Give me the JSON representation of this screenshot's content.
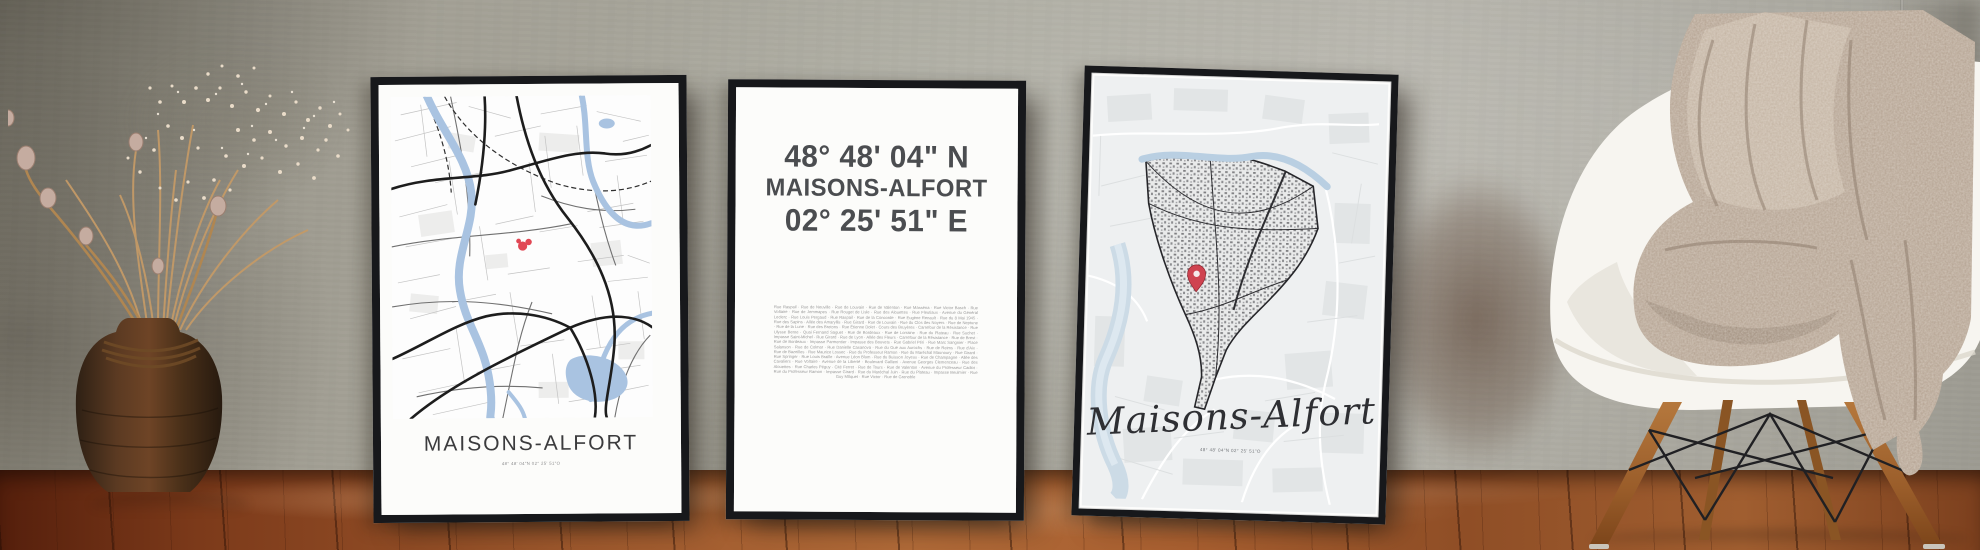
{
  "posters": {
    "left": {
      "title": "MAISONS-ALFORT",
      "coordinates": "48° 48' 04\"N  02° 25' 51\"O"
    },
    "middle": {
      "latitude": "48° 48' 04\" N",
      "city": "MAISONS-ALFORT",
      "longitude": "02° 25' 51\" E",
      "street_list": "Rue Raspail · Rue de Neuville · Rue de Louvain · Rue de Valenton · Rue Masséna · Rue Victor Basch · Rue Voltaire · Rue de Jemmapes · Rue Rouget de Lisle · Rue des Alouettes · Rue Fleutiaux · Avenue du Général Leclerc · Rue Louis Pergaud · Rue Raspail · Rue de la Concorde · Rue Eugène Renault · Rue du 8 Mai 1945 · Rue des Sapins · Allée des Amaryllis · Rue Girard · Rue de Louvain · Rue du Clos des Noyers · Rue de Neptune · Rue de la Lune · Rue des Bretons · Rue Étienne Dolet · Cours des Bruyères · Carrefour de la Résistance · Rue Ulysse Berne · Quai Fernand Saguet · Rue de Bordeaux · Rue de Lorraine · Rue du Plateau · Rue Suchet · Impasse Saint-Michel · Rue Girard · Rue de Lyon · Allée des Fleurs · Carrefour de la Résistance · Rue de Brest · Rue de Bordeaux · Impasse Parmentier · Impasse des Bouvets · Rue Gabriel Péri · Rue Marc Sangnier · Place Salanson · Rue de Colmar · Rue Danielle Casanova · Rue du Gué aux Aurochs · Rue de Reims · Rue d'Aix · Rue de Bazeilles · Rue Maurice Lossec · Rue du Professeur Ramon · Rue du Maréchal Maunoury · Rue Girard · Rue Springer · Rue Louis Braille · Avenue Léon Blum · Rue du Buisson Joyeux · Rue de Champagne · Allée des Cavaliers · Rue Voltaire · Avenue de la Liberté · Boulevard Gallieni · Avenue Georges Clemenceau · Rue des Alouettes · Rue Charles Péguy · Cité Ferret · Rue de Tours · Rue de Valenton · Avenue du Professeur Cadiot · Rue du Professeur Ramon · Impasse Girard · Rue du Maréchal Juin · Rue du Plateau · Impasse Beulmier · Rue Guy Môquet · Rue Victor · Rue de Grenoble"
    },
    "right": {
      "title": "Maisons-Alfort",
      "coordinates": "48° 48' 04\"N 02° 25' 51\"O"
    }
  },
  "colors": {
    "frame_black": "#17181b",
    "accent_red": "#d8414e",
    "water_blue": "#a9c3e1",
    "wall_gray": "#a8a59b",
    "floor_wood": "#8f4e26",
    "blanket_taupe": "#b5a493",
    "chair_shell_white": "#f7f5f0",
    "chair_leg_wood": "#a9672f"
  }
}
